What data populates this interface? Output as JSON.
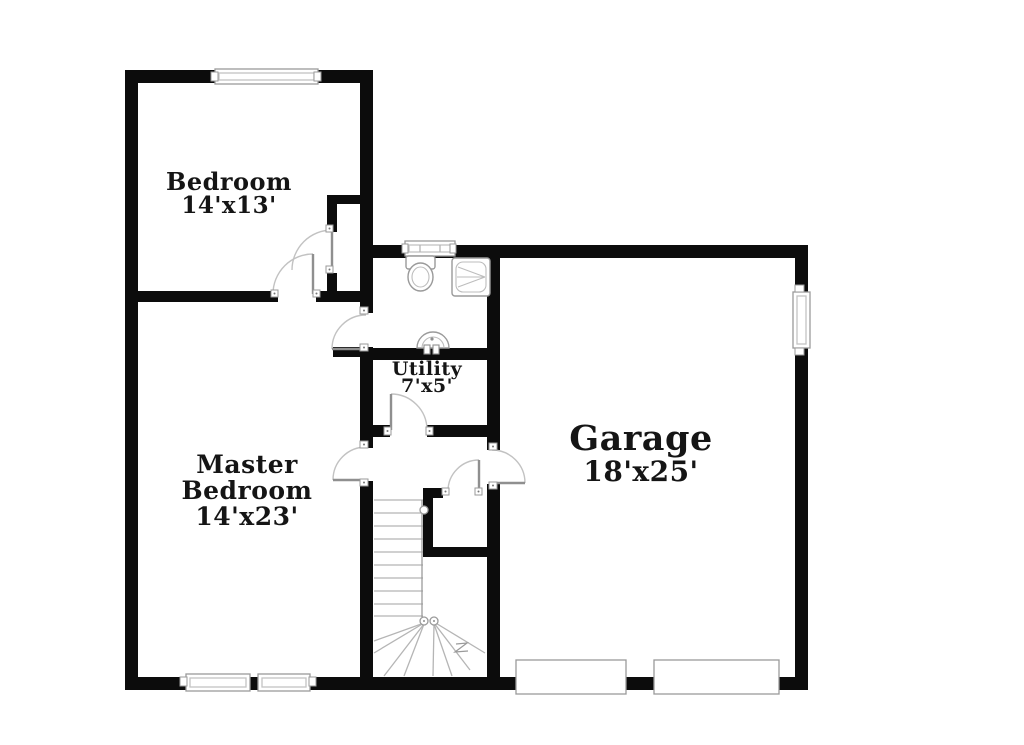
{
  "title": "Floor plan",
  "colors": {
    "wall": "#0c0c0c",
    "background": "#ffffff",
    "fixture_line": "#a3a3a3",
    "door_arc": "#c2c2c2",
    "text": "#151515"
  },
  "rooms": {
    "bedroom": {
      "label": "Bedroom",
      "dims": "14'x13'"
    },
    "master_bedroom": {
      "label_line1": "Master",
      "label_line2": "Bedroom",
      "dims": "14'x23'"
    },
    "utility": {
      "label": "Utility",
      "dims": "7'x5'"
    },
    "garage": {
      "label": "Garage",
      "dims": "18'x25'"
    }
  },
  "features": {
    "doors": [
      "bedroom-door",
      "bedroom-closet-door",
      "bathroom-door",
      "master-hall-door",
      "utility-door",
      "hall-garage-door",
      "stairs-closet-door"
    ],
    "windows": [
      "bedroom-window",
      "bathroom-window",
      "garage-side-window",
      "master-window-left",
      "master-window-right"
    ],
    "garage_doors": [
      "garage-door-left",
      "garage-door-right"
    ],
    "fixtures": [
      "toilet",
      "shower",
      "sink",
      "staircase"
    ]
  }
}
